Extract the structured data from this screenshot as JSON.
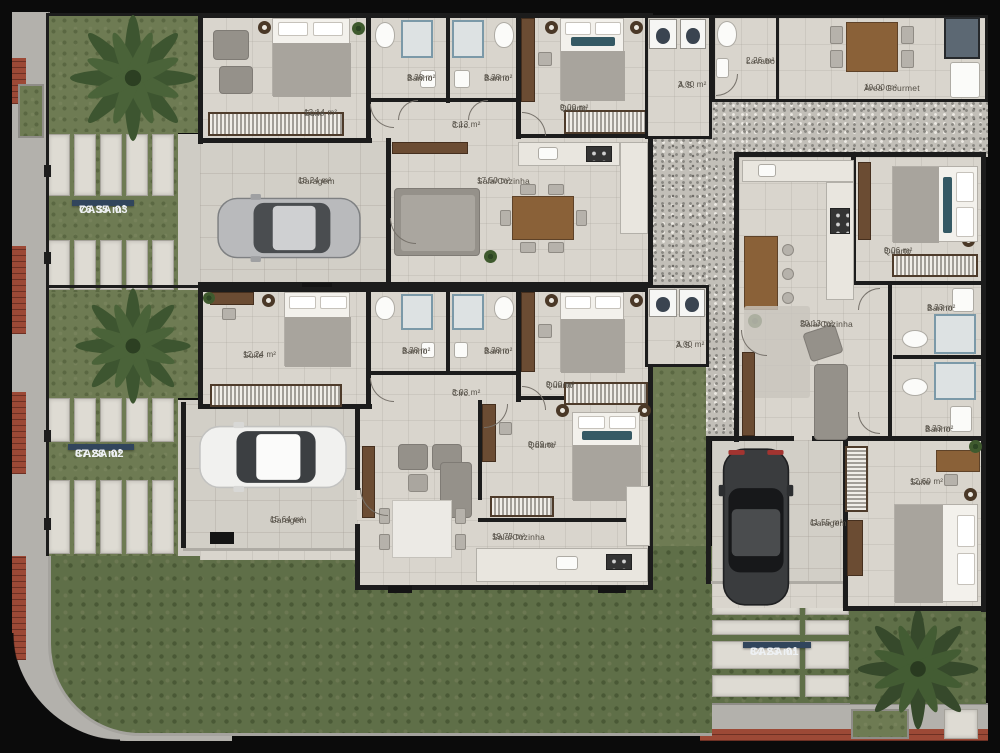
{
  "colors": {
    "frame": "#0b0b0b",
    "floor": "#d9d5cd",
    "wall": "#1c1c1c",
    "grass": "#6e7b53",
    "lawn": "#5f6f48",
    "gravel": "#c2bfb8",
    "brick": "#9c4936",
    "badge_navy": "#31455c"
  },
  "badges": {
    "casa03": {
      "name": "CASA 03",
      "area": "76.35 m²"
    },
    "casa02": {
      "name": "CASA 02",
      "area": "87.28 m²"
    },
    "casa01": {
      "name": "CASA 01",
      "area": "84.23 m²"
    }
  },
  "rooms": {
    "casa03": {
      "suite": {
        "name": "Suite",
        "area": "12.14 m²"
      },
      "banho1": {
        "name": "Banho",
        "area": "3.38 m²"
      },
      "banho2": {
        "name": "Banho",
        "area": "3.38 m²"
      },
      "quarto": {
        "name": "Quarto",
        "area": "9.00 m²"
      },
      "circ": {
        "name": "Circ.",
        "area": "3.13 m²"
      },
      "garagem": {
        "name": "Garagem",
        "area": "18.24 m²"
      },
      "sala": {
        "name": "Sala/Cozinha",
        "area": "17.50 m²"
      },
      "as": {
        "name": "A.S.",
        "area": "3.00 m²"
      }
    },
    "annex": {
      "lavabo": {
        "name": "Lavabo",
        "area": "2.26 m²"
      },
      "gourmet": {
        "name": "Área Gourmet",
        "area": "10.00 m²"
      }
    },
    "casa02": {
      "suite": {
        "name": "Suite",
        "area": "12.24 m²"
      },
      "banho1": {
        "name": "Banho",
        "area": "3.38 m²"
      },
      "banho2": {
        "name": "Banho",
        "area": "3.38 m²"
      },
      "quarto1": {
        "name": "Quarto",
        "area": "9.00 m²"
      },
      "circ": {
        "name": "Circ.",
        "area": "3.03 m²"
      },
      "quarto2": {
        "name": "Quarto",
        "area": "9.89 m²"
      },
      "garagem": {
        "name": "Garagem",
        "area": "15.64 m²"
      },
      "sala": {
        "name": "Sala/Cozinha",
        "area": "19.75 m²"
      },
      "as": {
        "name": "A.S.",
        "area": "3.00 m²"
      }
    },
    "casa01": {
      "quarto": {
        "name": "Quarto",
        "area": "9.06 m²"
      },
      "sala": {
        "name": "Sala/Cozinha",
        "area": "20.13 m²"
      },
      "banho1": {
        "name": "Banho",
        "area": "3.33 m²"
      },
      "banho2": {
        "name": "Banho",
        "area": "3.33 m²"
      },
      "suite": {
        "name": "Suite",
        "area": "12.60 m²"
      },
      "garagem": {
        "name": "Garagem",
        "area": "11.55 m²"
      }
    }
  }
}
